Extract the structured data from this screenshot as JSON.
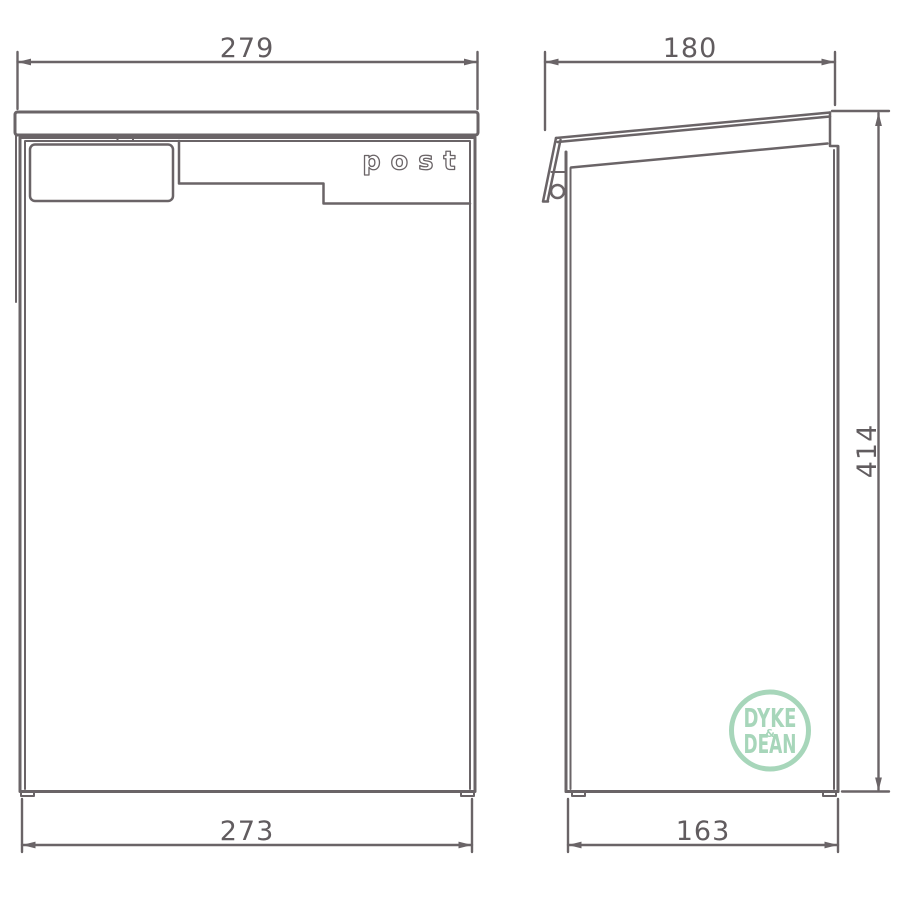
{
  "drawing": {
    "type": "technical-drawing",
    "subject": "post box elevations"
  },
  "colors": {
    "line": "#6a6467",
    "text": "#615c5f",
    "logo": "#a7d6ba",
    "background": "#ffffff"
  },
  "front_view": {
    "product_label": "post"
  },
  "dimensions": {
    "front_top_width": "279",
    "front_bottom_width": "273",
    "side_top_depth": "180",
    "side_bottom_depth": "163",
    "side_height": "414"
  },
  "logo": {
    "word_top": "DYKE",
    "ampersand": "&",
    "word_bottom": "DEAN"
  }
}
